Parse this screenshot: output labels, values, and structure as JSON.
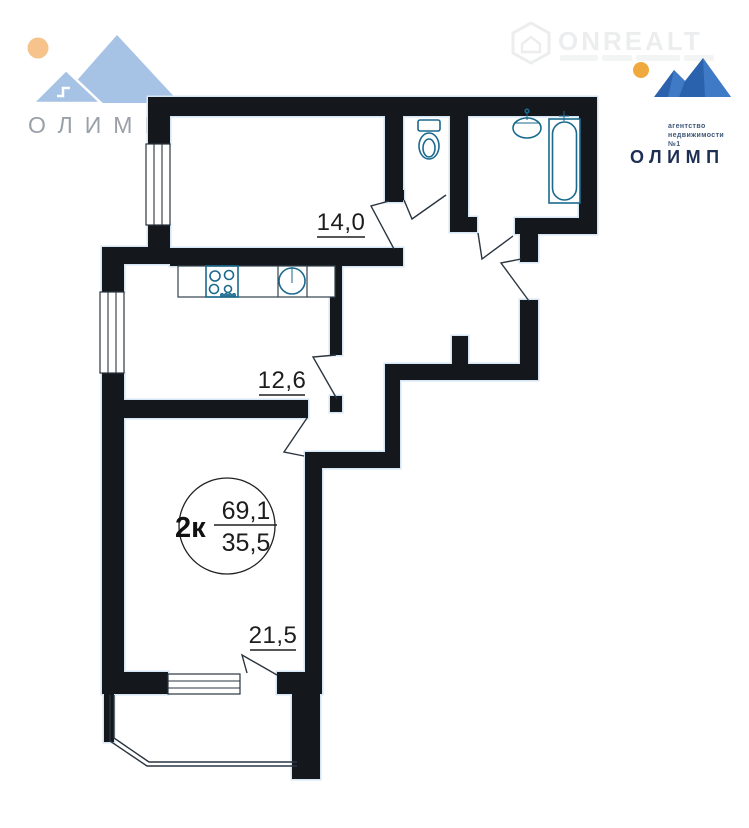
{
  "watermark": {
    "brand": "ONREALT",
    "icon": "house-hexagon-icon"
  },
  "logo_top_left": {
    "brand": "ОЛИМП"
  },
  "logo_top_right": {
    "brand": "ОЛИМП",
    "tagline": [
      "агентство",
      "недвижимости",
      "№1"
    ]
  },
  "floorplan": {
    "type": "apartment-floor-plan",
    "stamp": {
      "rooms": "2к",
      "total_area": "69,1",
      "living_area": "35,5"
    },
    "room_areas": {
      "bedroom": "14,0",
      "kitchen": "12,6",
      "living_room": "21,5"
    },
    "fixtures": [
      "toilet",
      "sink",
      "bathtub",
      "stove",
      "kitchen-sink"
    ],
    "colors": {
      "wall": "#14171c",
      "wall_halo": "#d5e5f3",
      "fixture_stroke": "#1a6a8e",
      "label_ink": "#1d1d1d",
      "logo_blue_light": "#a6c3e6",
      "logo_blue_dark": "#2a62ad",
      "sun_left": "#f6c38c",
      "sun_right": "#f0a93e"
    }
  }
}
